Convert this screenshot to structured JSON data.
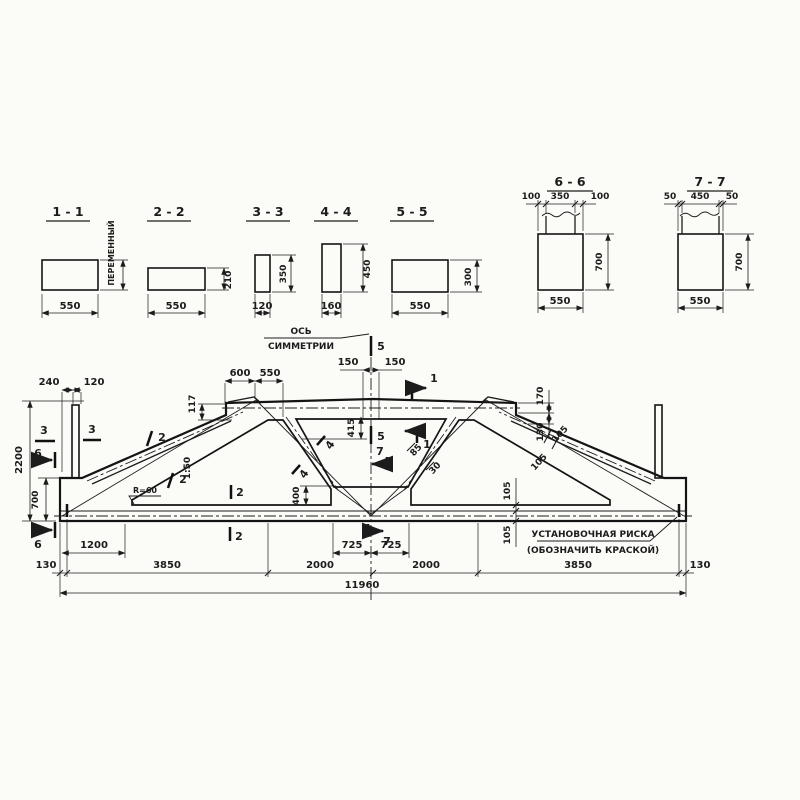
{
  "style": {
    "ink": "#1c1c1c",
    "paper": "#fbfbf8"
  },
  "sec": {
    "s11": {
      "t": "1 - 1",
      "w": "550",
      "h": "ПЕРЕМЕННЫЙ"
    },
    "s22": {
      "t": "2 - 2",
      "w": "550",
      "h": "210"
    },
    "s33": {
      "t": "3 - 3",
      "w": "120",
      "h": "350"
    },
    "s44": {
      "t": "4 - 4",
      "w": "160",
      "h": "450"
    },
    "s55": {
      "t": "5 - 5",
      "w": "550",
      "h": "300"
    },
    "s66": {
      "t": "6 - 6",
      "a": "100",
      "b": "350",
      "c": "100",
      "h": "700",
      "w": "550"
    },
    "s77": {
      "t": "7 - 7",
      "a": "50",
      "b": "450",
      "c": "50",
      "h": "700",
      "w": "550"
    }
  },
  "elev": {
    "axis1": "ОСЬ",
    "axis2": "СИММЕТРИИ",
    "note1": "УСТАНОВОЧНАЯ РИСКА",
    "note2": "(ОБОЗНАЧИТЬ КРАСКОЙ)",
    "slope": "1:50",
    "rad": "R=60",
    "d": {
      "v150a": "150",
      "v150b": "150",
      "v600": "600",
      "v550": "550",
      "v117": "117",
      "v240": "240",
      "v120": "120",
      "v170": "170",
      "v130": "130",
      "v415": "415",
      "v400": "400",
      "v2200": "2200",
      "v700": "700",
      "v85": "85",
      "v30": "30",
      "v105a": "105",
      "v105b": "105",
      "v105c": "105",
      "v105d": "105",
      "v1200": "1200",
      "v725a": "725",
      "v725b": "725",
      "v130a": "130",
      "v3850a": "3850",
      "v2000a": "2000",
      "v2000b": "2000",
      "v3850b": "3850",
      "v130b": "130",
      "v11960": "11960"
    },
    "m": {
      "m1a": "1",
      "m1b": "1",
      "m2a": "2",
      "m2b": "2",
      "m2c": "2",
      "m2d": "2",
      "m3a": "3",
      "m3b": "3",
      "m4a": "4",
      "m4b": "4",
      "m5a": "5",
      "m5b": "5",
      "m6a": "6",
      "m6b": "6",
      "m7a": "7",
      "m7b": "7"
    }
  }
}
